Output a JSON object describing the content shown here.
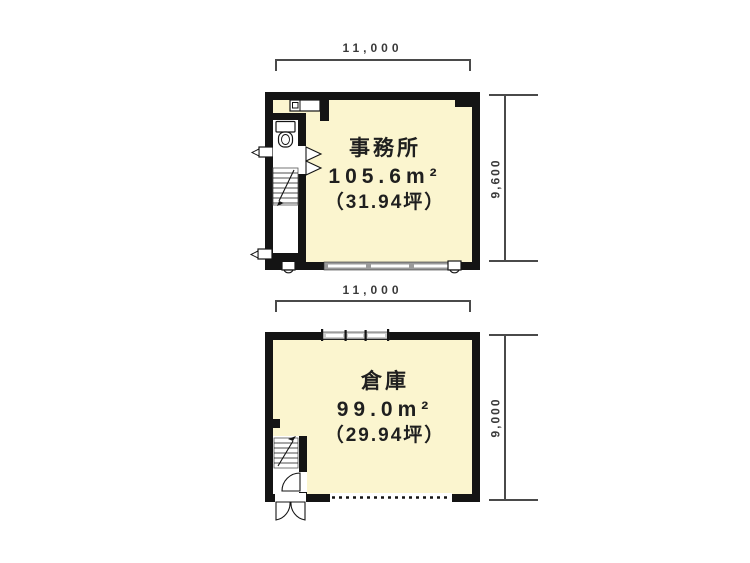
{
  "title": "floor-plan",
  "colors": {
    "wall": "#141414",
    "floor_fill": "#fbf5cf",
    "dimension_line": "#4a4a4a",
    "text": "#1f1f1f",
    "window_gray": "#9a9a9a",
    "background": "#ffffff"
  },
  "floors": [
    {
      "id": "office",
      "label": "事務所",
      "area_m2": "105.6m²",
      "area_tsubo": "（31.94坪）",
      "dim_width": "11,000",
      "dim_height": "9,600",
      "fixtures": [
        "toilet-icon",
        "sink-counter-icon",
        "stairs-icon",
        "folding-door-icon",
        "window-icon",
        "pipe-icon",
        "valve-icon"
      ]
    },
    {
      "id": "warehouse",
      "label": "倉庫",
      "area_m2": "99.0m²",
      "area_tsubo": "（29.94坪）",
      "dim_width": "11,000",
      "dim_height": "9,000",
      "fixtures": [
        "stairs-icon",
        "swing-door-icon",
        "entrance-door-icon",
        "window-icon",
        "shutter-opening-icon"
      ]
    }
  ]
}
